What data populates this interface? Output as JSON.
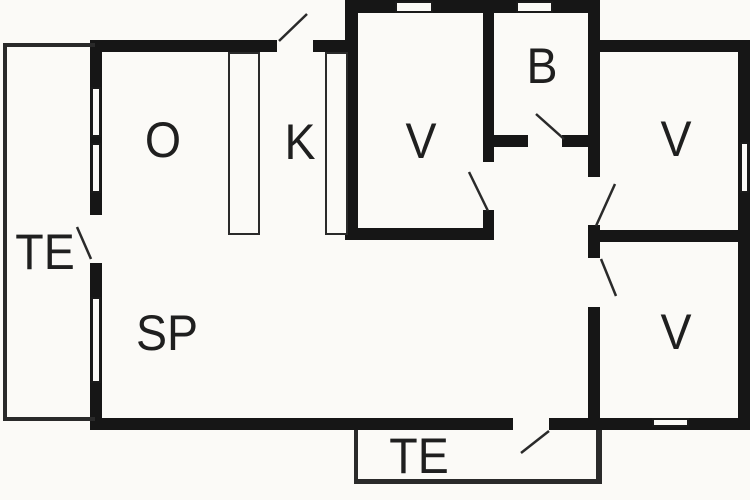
{
  "title": "Floor plan",
  "colors": {
    "background": "#fbfaf7",
    "wall": "#161616",
    "label": "#1f1f1f",
    "door_line": "#2a2a2a"
  },
  "rooms": [
    {
      "label": "O",
      "x": 163,
      "y": 140
    },
    {
      "label": "K",
      "x": 300,
      "y": 142
    },
    {
      "label": "V",
      "x": 421,
      "y": 141
    },
    {
      "label": "B",
      "x": 542,
      "y": 66
    },
    {
      "label": "V",
      "x": 676,
      "y": 139
    },
    {
      "label": "V",
      "x": 676,
      "y": 332
    },
    {
      "label": "SP",
      "x": 167,
      "y": 333
    },
    {
      "label": "TE",
      "x": 45,
      "y": 252
    },
    {
      "label": "TE",
      "x": 419,
      "y": 456
    }
  ],
  "geometry": {
    "walls": [
      [
        345,
        0,
        255,
        13
      ],
      [
        90,
        40,
        187,
        12
      ],
      [
        313,
        40,
        45,
        12
      ],
      [
        588,
        40,
        162,
        12
      ],
      [
        90,
        40,
        12,
        175
      ],
      [
        90,
        263,
        12,
        167
      ],
      [
        345,
        0,
        13,
        240
      ],
      [
        483,
        13,
        11,
        149
      ],
      [
        483,
        210,
        11,
        30
      ],
      [
        483,
        135,
        45,
        12
      ],
      [
        562,
        135,
        38,
        12
      ],
      [
        345,
        228,
        149,
        12
      ],
      [
        588,
        0,
        12,
        177
      ],
      [
        588,
        225,
        12,
        33
      ],
      [
        588,
        307,
        12,
        123
      ],
      [
        588,
        230,
        162,
        12
      ],
      [
        738,
        40,
        12,
        390
      ],
      [
        90,
        418,
        423,
        12
      ],
      [
        549,
        418,
        201,
        12
      ]
    ],
    "windows": [
      [
        91,
        87,
        10,
        50
      ],
      [
        91,
        143,
        10,
        50
      ],
      [
        91,
        297,
        10,
        86
      ],
      [
        395,
        1,
        38,
        12
      ],
      [
        516,
        1,
        37,
        12
      ],
      [
        740,
        142,
        9,
        51
      ],
      [
        652,
        418,
        37,
        9
      ]
    ],
    "counters": [
      [
        228,
        52,
        32,
        183
      ],
      [
        325,
        52,
        23,
        183
      ]
    ],
    "terrace_lines": [
      [
        3,
        43,
        92,
        4
      ],
      [
        3,
        43,
        4,
        378
      ],
      [
        3,
        417,
        92,
        4
      ],
      [
        354,
        430,
        4,
        53
      ],
      [
        354,
        479,
        248,
        5
      ],
      [
        596,
        430,
        6,
        53
      ]
    ],
    "door_swings": [
      [
        279,
        41,
        307,
        14
      ],
      [
        536,
        114,
        564,
        139
      ],
      [
        469,
        172,
        488,
        211
      ],
      [
        615,
        184,
        596,
        226
      ],
      [
        601,
        259,
        616,
        296
      ],
      [
        77,
        227,
        91,
        259
      ],
      [
        549,
        431,
        521,
        453
      ]
    ]
  }
}
